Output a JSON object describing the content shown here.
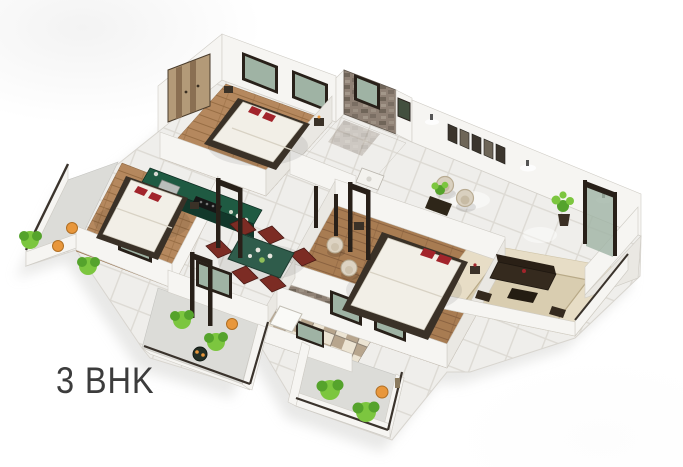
{
  "title": "3 BHK",
  "scene": {
    "type": "isometric-3d-floor-plan-render",
    "rooms": [
      {
        "id": "bedroom-1",
        "floor": "wood",
        "furniture": [
          "double-bed-white-linen-red-pillows",
          "wardrobe",
          "nightstands"
        ]
      },
      {
        "id": "kitchen",
        "floor": "tile",
        "furniture": [
          "green-l-counter",
          "sink",
          "hob",
          "dishes"
        ]
      },
      {
        "id": "bedroom-2",
        "floor": "wood",
        "furniture": [
          "double-bed-white-linen-red-pillows",
          "nightstand"
        ]
      },
      {
        "id": "dining-area",
        "floor": "tile",
        "furniture": [
          "green-top-table",
          "six-maroon-chairs"
        ]
      },
      {
        "id": "living-hall",
        "floor": "tile",
        "furniture": [
          "two-wicker-chairs",
          "wall-art-frames",
          "console-with-plant",
          "potted-plant"
        ]
      },
      {
        "id": "bathroom-1",
        "floor": "stone-tile",
        "furniture": [
          "basin-console",
          "mirror"
        ]
      },
      {
        "id": "bedroom-3",
        "floor": "wood",
        "furniture": [
          "double-bed-white-linen-red-pillows",
          "two-beige-chairs",
          "nightstands"
        ]
      },
      {
        "id": "bathroom-2",
        "floor": "checker-tile",
        "furniture": [
          "tub",
          "stone-accent-wall"
        ]
      },
      {
        "id": "lounge-terrace",
        "floor": "beige-rug",
        "furniture": [
          "dark-sofa-set",
          "coffee-table",
          "ottomans",
          "glass-door",
          "potted-plant"
        ]
      },
      {
        "id": "balcony-left",
        "floor": "concrete",
        "furniture": [
          "green-bushes",
          "orange-stools",
          "dark-railing"
        ]
      },
      {
        "id": "balcony-bottom",
        "floor": "concrete",
        "furniture": [
          "green-bushes",
          "orange-chair",
          "round-table"
        ]
      },
      {
        "id": "balcony-front",
        "floor": "concrete",
        "furniture": [
          "green-bushes",
          "orange-chair",
          "vase"
        ]
      }
    ],
    "palette": {
      "bg": "#ffffff",
      "wall": "#f6f5f2",
      "wallShade": "#eae8e3",
      "wallEdge": "#cfccc5",
      "wood1": "#b5885e",
      "wood1Dark": "#976d44",
      "wood2": "#a87c52",
      "wood2Dark": "#8a6240",
      "tile": "#efeeeb",
      "tileLine": "#dddad4",
      "counterTop": "#1f5a42",
      "counterFront": "#12382b",
      "bedLinen": "#f2efe7",
      "bedFrame": "#3a3127",
      "pillow": "#a2242b",
      "chairMaroon": "#7c2c24",
      "tableGreen": "#2f5c4b",
      "sofa": "#352a1e",
      "rug": "#d9cdb0",
      "terraceFloor": "#e7ddc6",
      "plant": "#7cc63f",
      "plantDark": "#55a32c",
      "orange": "#e8973c",
      "stone": "#8f8175",
      "stoneDark": "#6b6055",
      "checkA": "#ece4d3",
      "checkB": "#b7a58d",
      "concrete": "#dcdcd8",
      "shadow": "#d9d9d7",
      "text": "#3c3c3c"
    }
  }
}
